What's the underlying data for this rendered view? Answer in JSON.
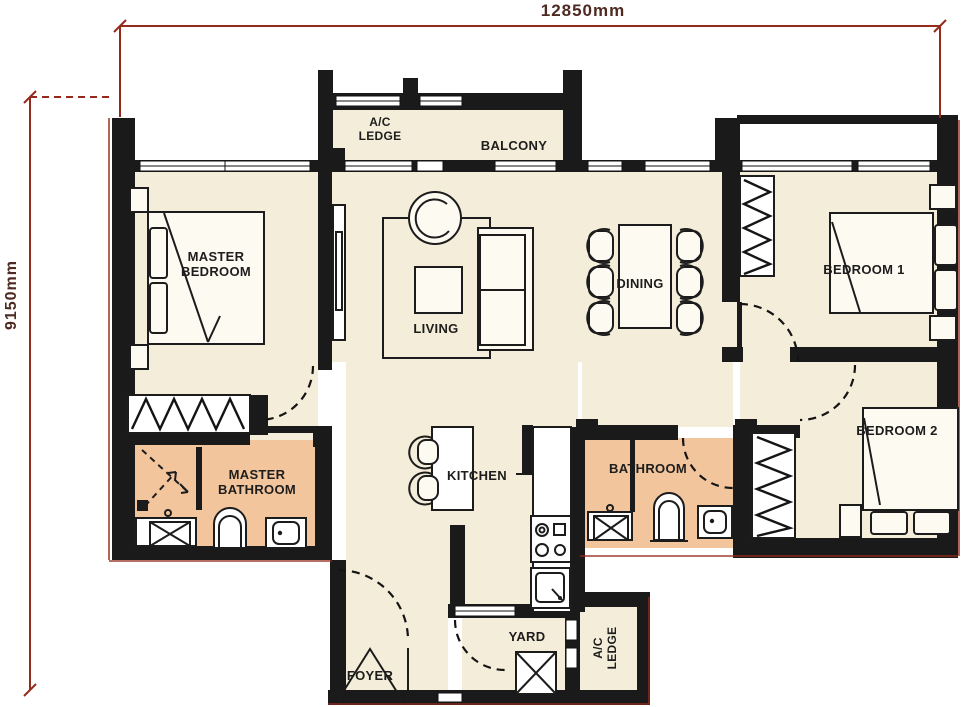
{
  "dimensions": {
    "top": "12850mm",
    "left": "9150mm"
  },
  "rooms": {
    "master_bedroom": {
      "label": "MASTER BEDROOM"
    },
    "living": {
      "label": "LIVING"
    },
    "dining": {
      "label": "DINING"
    },
    "bedroom1": {
      "label": "BEDROOM 1"
    },
    "bedroom2": {
      "label": "BEDROOM 2"
    },
    "master_bathroom": {
      "label": "MASTER BATHROOM"
    },
    "bathroom": {
      "label": "BATHROOM"
    },
    "kitchen": {
      "label": "KITCHEN"
    },
    "yard": {
      "label": "YARD"
    },
    "foyer": {
      "label": "FOYER"
    },
    "balcony": {
      "label": "BALCONY"
    },
    "ac_ledge_top": {
      "label": "A/C LEDGE"
    },
    "ac_ledge_bottom": {
      "label": "A/C LEDGE"
    }
  },
  "colors": {
    "floor": "#f4edd9",
    "wet": "#f2c59d",
    "wall": "#1a1a1a",
    "dimension_line": "#942a1b",
    "dimension_text": "#4e2a23"
  }
}
